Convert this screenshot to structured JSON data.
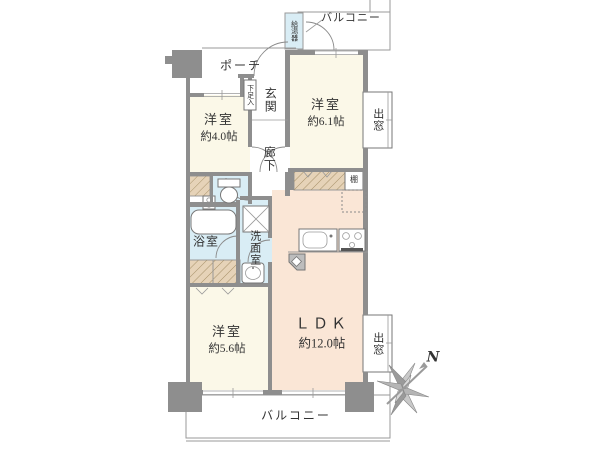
{
  "plan": {
    "title": "apartment-floor-plan",
    "rooms": {
      "balcony_top": {
        "label": "バルコニー"
      },
      "water_heater": {
        "label": "給湯器"
      },
      "porch": {
        "label": "ポーチ"
      },
      "shoe_box": {
        "label": "下足入"
      },
      "entrance": {
        "label": "玄関"
      },
      "bedroom_4": {
        "label": "洋室",
        "size": "約4.0帖"
      },
      "bedroom_6": {
        "label": "洋室",
        "size": "約6.1帖"
      },
      "bay_window_top": {
        "label": "出窓"
      },
      "hallway": {
        "label": "廊下"
      },
      "shelf": {
        "label": "棚"
      },
      "bathroom": {
        "label": "浴室"
      },
      "washroom": {
        "label": "洗面室"
      },
      "bedroom_5": {
        "label": "洋室",
        "size": "約5.6帖"
      },
      "ldk": {
        "label": "ＬＤＫ",
        "size": "約12.0帖"
      },
      "bay_window_bottom": {
        "label": "出窓"
      },
      "balcony_bottom": {
        "label": "バルコニー"
      },
      "compass": {
        "label": "N"
      }
    },
    "colors": {
      "room": "#FBF8E8",
      "ldk": "#FAE6D6",
      "wet": "#D9EDF5",
      "closet": "#E6D3B8",
      "wall": "#8E8E8E",
      "line": "#9A9A9A",
      "text": "#333333"
    }
  }
}
